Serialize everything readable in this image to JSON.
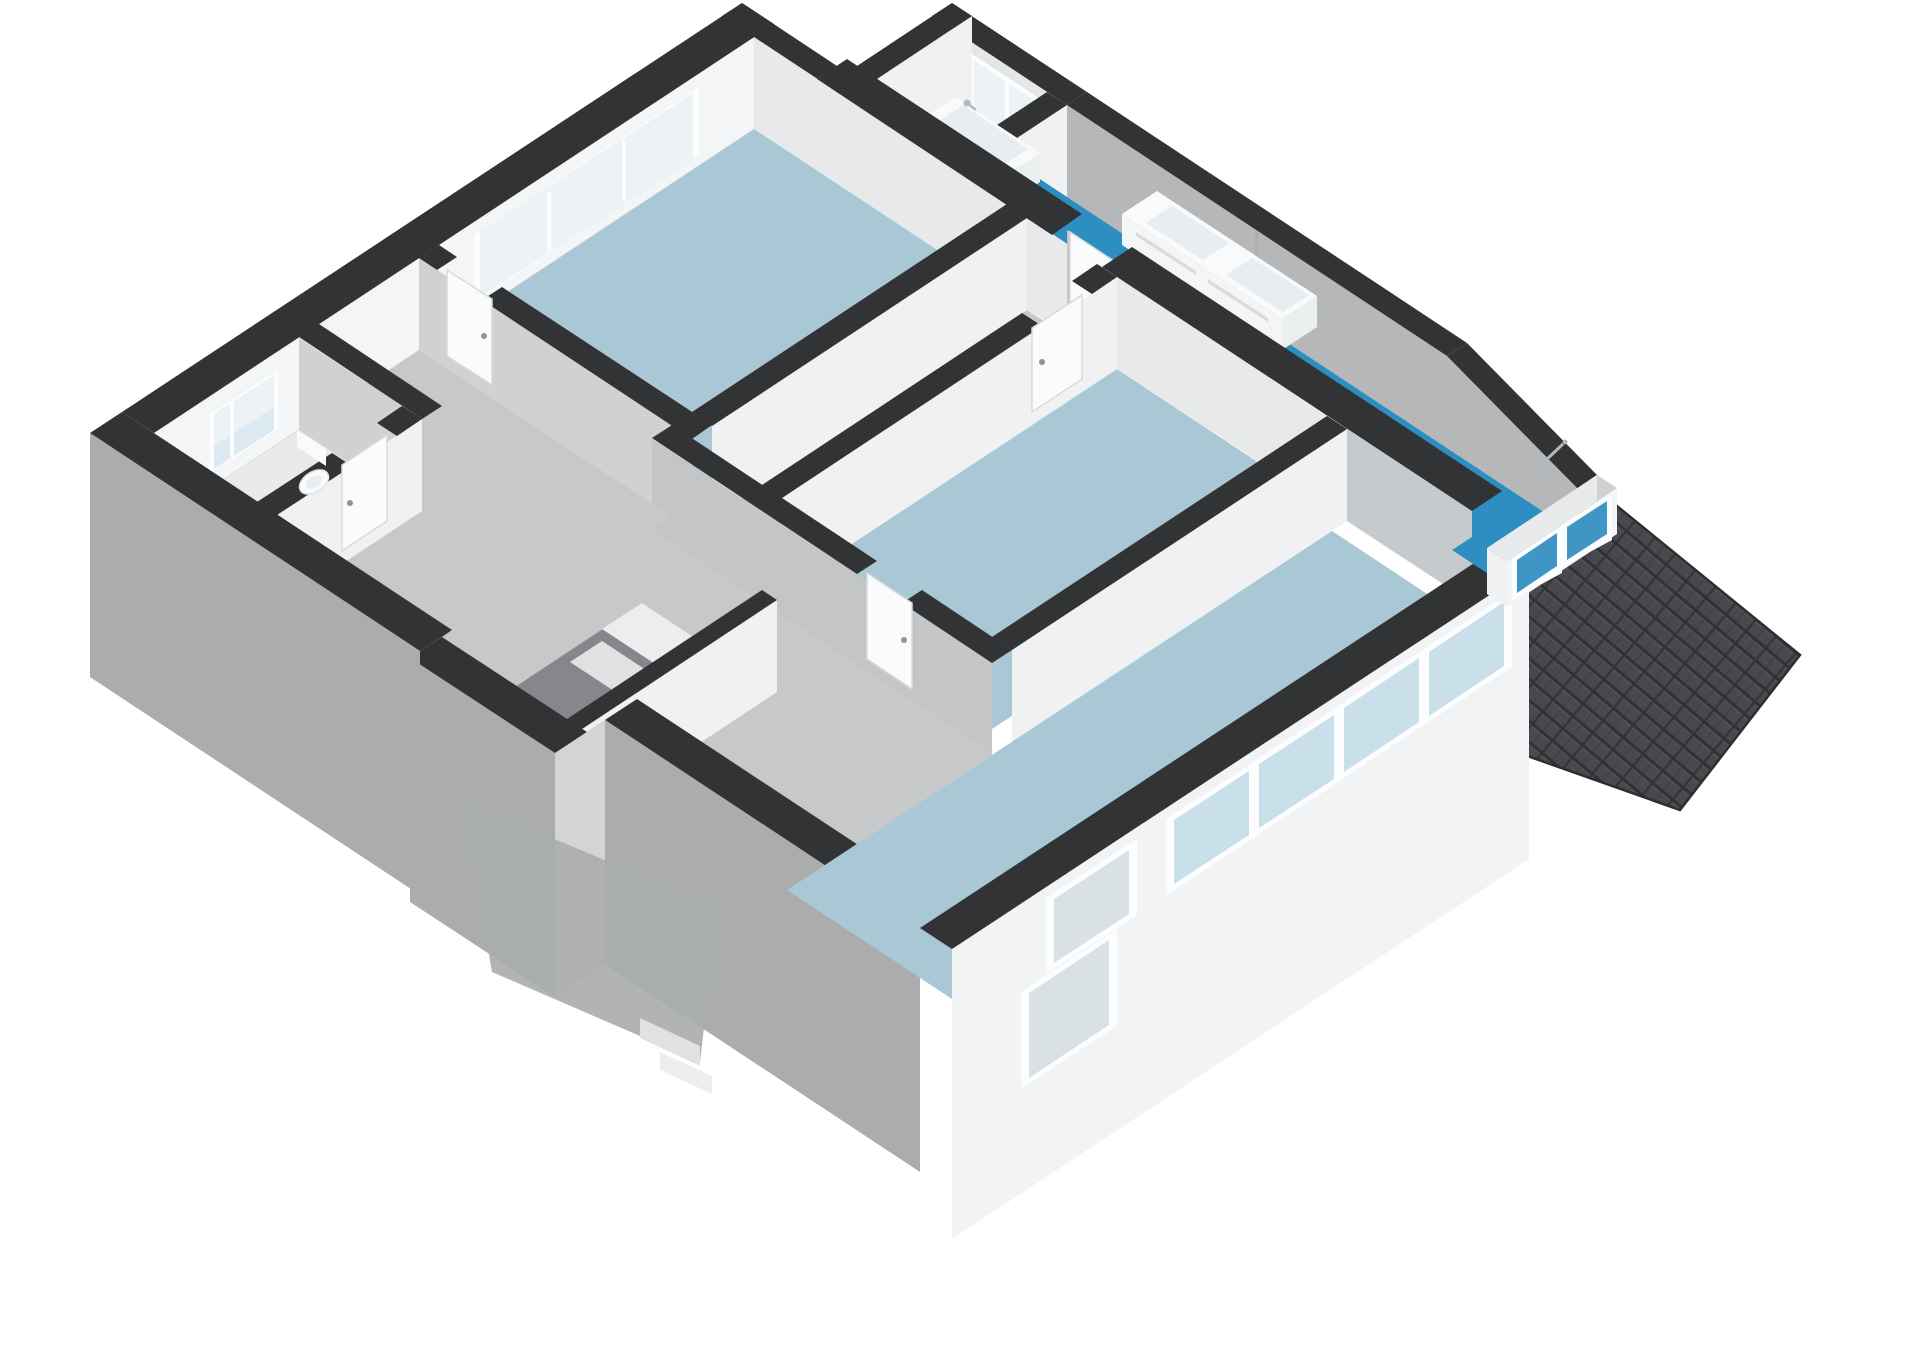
{
  "meta": {
    "description": "isometric-3d-floorplan-render",
    "canvas": {
      "width": 1920,
      "height": 1358
    },
    "background": "#ffffff"
  },
  "palette": {
    "background": "#ffffff",
    "wall_cap": "#323335",
    "cap_light": "#e8eaec",
    "wall_white": "#f3f5f6",
    "wall_white2": "#eff1f3",
    "wall_light": "#e7e9eb",
    "wall_shaded": "#cfd1d3",
    "wall_gray2": "#c3c5c7",
    "wall_gray": "#b5b7b9",
    "nook_wall": "#e4e6e8",
    "overlay_gray": "#c7cacc",
    "ext_sw": "#aaacae",
    "ext_sw_step": "#d2d4d6",
    "ext_se": "#f1f3f4",
    "floor_room": "#a9c7d4",
    "floor_hall": "#c6c8ca",
    "floor_toilet": "#e8eaec",
    "floor_bath": "#2d8ec1",
    "stair_void": "#85878b",
    "step1": "#ecedee",
    "step2": "#dfe1e2",
    "glass_frost": "#edf2f5",
    "glass_tint": "#cfe3ed",
    "glass_band": "#c9dfe9",
    "glass_lower": "#d9e1e5",
    "glass_teal": "#3f96c4",
    "frame": "#fcfdfe",
    "fixture": "#f8fafb",
    "fixture_inner": "#e9edef",
    "fixture_side": "#eceff0",
    "fixture_front": "#f3f5f6",
    "groove": "#d8dbdd",
    "chrome": "#b4b9bd",
    "roof_base": "#47494c",
    "roof_line": "#303236",
    "roof_hl": "#54575a",
    "roof_edge": "#2c2e30",
    "door_leaf": "#fafbfc",
    "door_edge": "#d8dadb",
    "handle": "#8e9296",
    "bowl_edge": "#dfe2e4",
    "seam": "#a9abad",
    "basin_rim": "#f8fafb"
  },
  "scene": {
    "rooms": [
      {
        "name": "bedroom-top-left",
        "floor": "light-blue"
      },
      {
        "name": "corridor",
        "floor": "gray"
      },
      {
        "name": "bedroom-middle",
        "floor": "light-blue"
      },
      {
        "name": "living-room-bottom-right",
        "floor": "light-blue"
      },
      {
        "name": "hallway-landing",
        "floor": "gray"
      },
      {
        "name": "toilet-room",
        "floor": "light-gray"
      },
      {
        "name": "bathroom-wing",
        "floor": "teal-blue"
      }
    ],
    "fixtures": [
      "bathtub",
      "double-sink-vanity",
      "shower-head",
      "toilet",
      "staircase"
    ],
    "features": [
      "tiled-roof-section",
      "dormer-windows",
      "window-band",
      "frosted-windows",
      "dark-wall-caps"
    ]
  }
}
